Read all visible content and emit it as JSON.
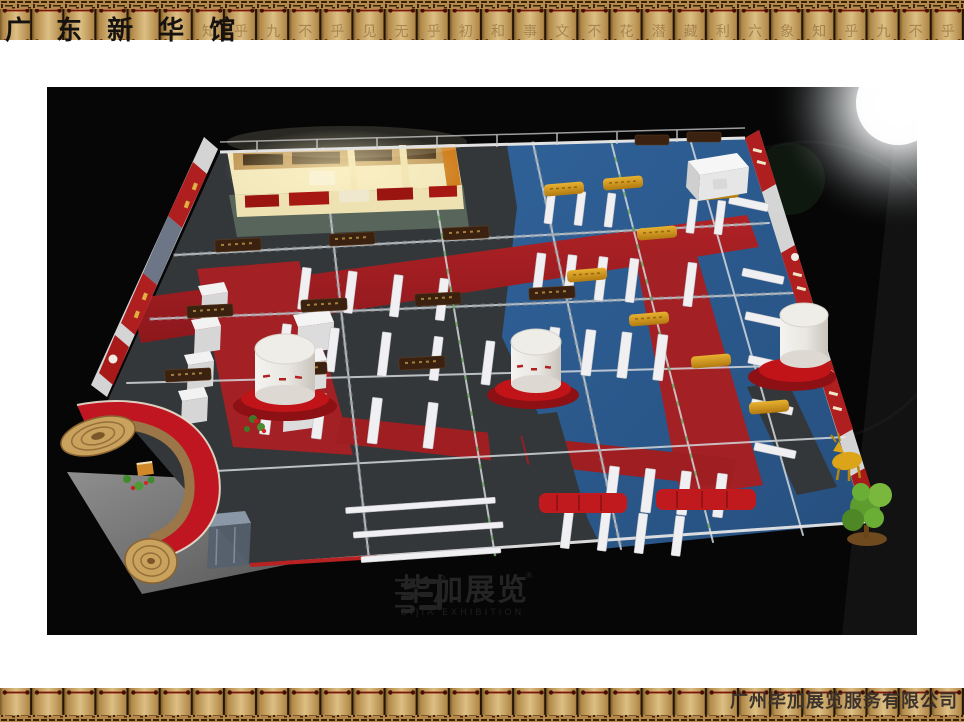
{
  "slide": {
    "title": "广 东 新 华 馆",
    "footer_company": "广州毕加展览服务有限公司"
  },
  "border": {
    "top_slat_chars": [
      "",
      "",
      "",
      "",
      "",
      "",
      "知",
      "乎",
      "九",
      "不",
      "乎",
      "见",
      "无",
      "乎",
      "初",
      "和",
      "事",
      "文",
      "不",
      "花",
      "潜",
      "藏",
      "利",
      "六",
      "象",
      "知",
      "乎",
      "九",
      "不",
      "乎"
    ]
  },
  "watermark": {
    "cn": "毕加展览",
    "en": "BIJIA EXHIBITION",
    "reg": "®"
  },
  "colors": {
    "border_tan": "#d2ac6c",
    "border_dark": "#3a2208",
    "binding_red": "#7c1608",
    "carpet_red": "#a32024",
    "carpet_blue": "#2d5d92",
    "carpet_charcoal": "#3b3f43",
    "banner_red": "#b01f1f",
    "sign_gold": "#d89d20",
    "arch_red": "#c01622",
    "scroll_wood": "#c9a25e"
  }
}
